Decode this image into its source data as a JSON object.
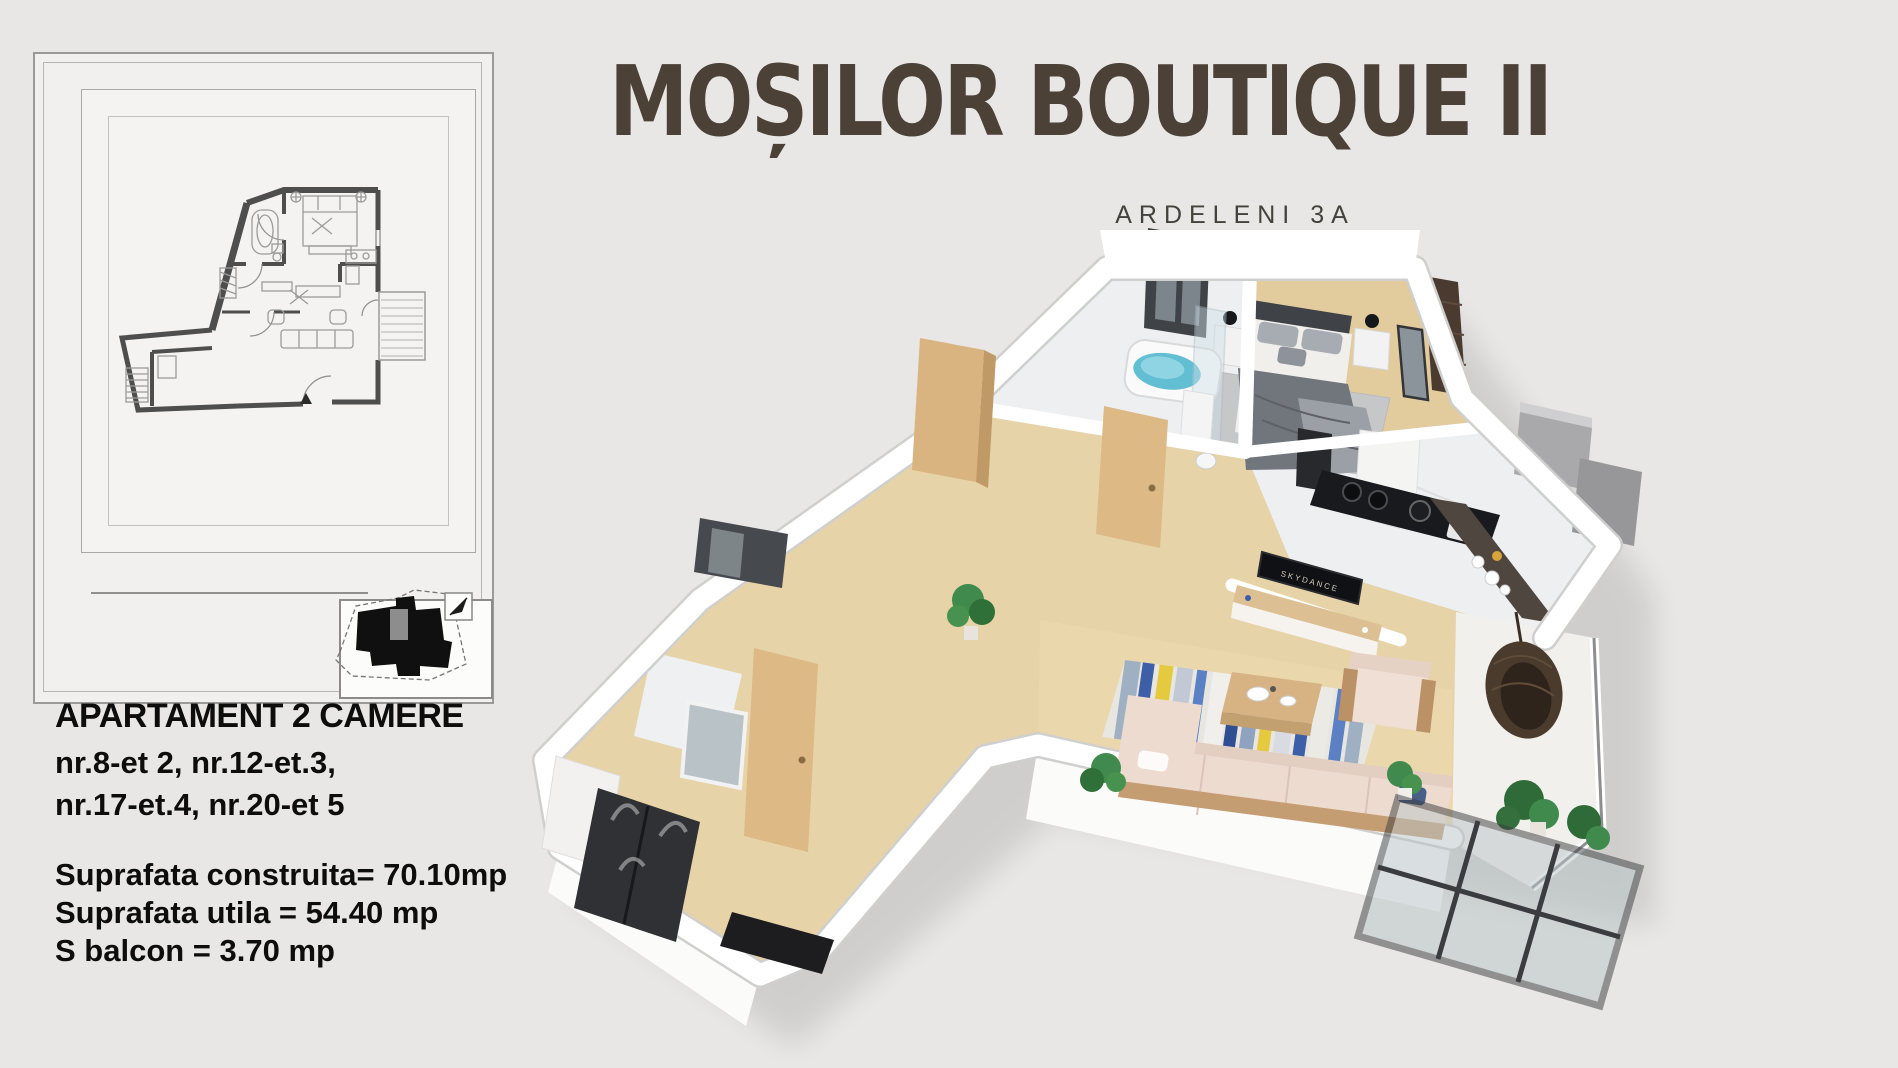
{
  "header": {
    "title": "MOȘILOR BOUTIQUE II",
    "subtitle": "ARDELENI 3A",
    "title_color": "#4c4136"
  },
  "details": {
    "heading": "APARTAMENT 2 CAMERE",
    "units_line1": "nr.8-et 2, nr.12-et.3,",
    "units_line2": "nr.17-et.4, nr.20-et 5",
    "area_construita": "Suprafata construita= 70.10mp",
    "area_utila": "Suprafata utila = 54.40 mp",
    "area_balcon": "S balcon = 3.70 mp"
  },
  "render3d": {
    "tv_brand": "SKYDANCE",
    "rooms": [
      "bathroom",
      "bedroom",
      "kitchen",
      "hallway",
      "living-room",
      "balcony",
      "entrance"
    ],
    "colors": {
      "wall": "#ffffff",
      "wood_floor": "#e7d3a8",
      "marble_floor": "#edeff0",
      "sofa_pink": "#eedbd0",
      "rug_blue": "#3c5fa8",
      "rug_yellow": "#e5c93e",
      "kitchen_counter": "#191a1d",
      "wardrobe_brown": "#4a3a2f",
      "oak_door": "#dcb985",
      "plant_green": "#3f8a4c",
      "bath_water": "#62bed2",
      "page_background": "#e8e7e5"
    }
  }
}
